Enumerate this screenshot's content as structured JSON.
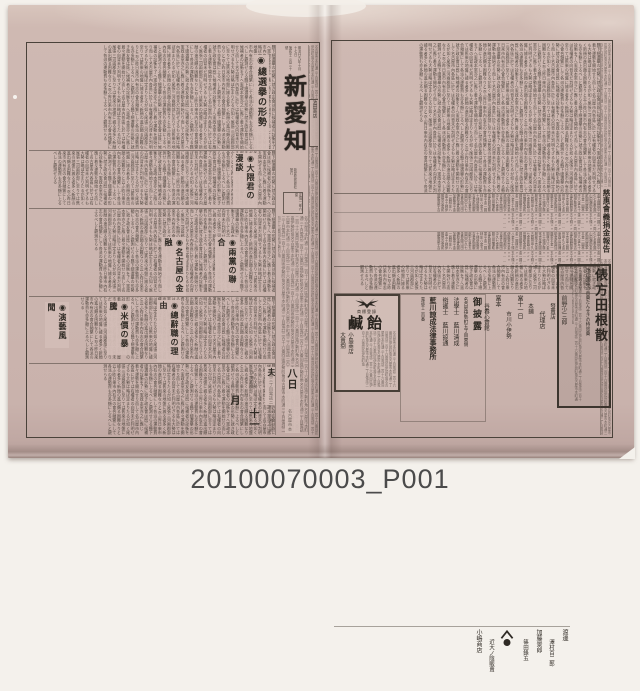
{
  "photo_label": {
    "id_text": "20100070003_P001"
  },
  "colors": {
    "paper": "#ccb6b0",
    "backdrop": "#f4f1ec",
    "ink": "#3a332c",
    "frame": "#4a423a"
  },
  "filler": {
    "body": "縣下總選擧の形勢に就き政友會は既に候補者の詮衡を了へ憲政本黨亦之に應じ着々運動を開始せり而して名古屋市內各區に於ては有權者の向背未だ判明せざるも大勢は略ぼ定まりたるが如く尾張三河兩郡部に至りては舊來の地盤に據る者多く新顏の進出頗る困難なりと云ふ昨日來市內有志の會合頻繁にして各派の運動費も亦多額に上るべしと觀測せらる",
    "roster": "金五圓田中久七金參圓山田彌助金貳圓加藤軍平金一圓林庄八金五十錢伊藤常吉金貳圓服部宇吉",
    "roster_dots": "金一圓〃〃〃〃〃〃同五十錢〃〃〃〃〃〃………………………………",
    "tiny": "名古屋市本町通三丁目電話二百十六番同區伊勢町角"
  },
  "left_page": {
    "masthead": {
      "date_line": "明治廿九年十月十七日",
      "issue_line": "第貳千三百三十號",
      "title": "新愛知",
      "publisher_line": "新愛知新聞社發行",
      "seal_text": "定價一部六厘"
    },
    "headlines": [
      {
        "text": "◉總選擧の形勢"
      },
      {
        "text": "◉大隈君の漫談"
      },
      {
        "text": "◉兩黨の聯合"
      },
      {
        "text": "◉名古屋の金融"
      },
      {
        "text": "◉總辭職の理由"
      },
      {
        "text": "◉米價の暴騰"
      },
      {
        "text": "◉演藝風聞"
      },
      {
        "text": "◉義太夫"
      }
    ],
    "date_column": {
      "day": "八日",
      "month": "十一月"
    },
    "classified_label": "池田商店"
  },
  "right_page": {
    "donation_headline": "慈惠會義捐金報告",
    "ads": {
      "candy": {
        "mark": "商標登錄",
        "name": "鹹飴",
        "seller_role": "大賣捌",
        "seller": "小島商店"
      },
      "announce": {
        "title": "御披露",
        "address": "名古屋伊勢町五丁目東側",
        "line1": "法學士 藍川清成",
        "line2": "辯護士 藍川諒通",
        "office": "藍川諒成法律事務所",
        "tail": "電話千二百番"
      },
      "medicine": {
        "name": "俵方田根散",
        "tagline": "改良賣藥の首藥たんせきの特效藥"
      },
      "names_column": [
        "前野少三郎",
        "發賣店",
        "代理店",
        "本鋪",
        "當十一日",
        "市川小伊勢",
        "富本",
        "谷春心齋館",
        "土屋聲兵衛"
      ],
      "bottom_names": [
        "渡邊",
        "澤村百二郎",
        "加藤景郎",
        "篠田錄五",
        "近大ノ陰販賣",
        "小嶋商店"
      ]
    }
  }
}
